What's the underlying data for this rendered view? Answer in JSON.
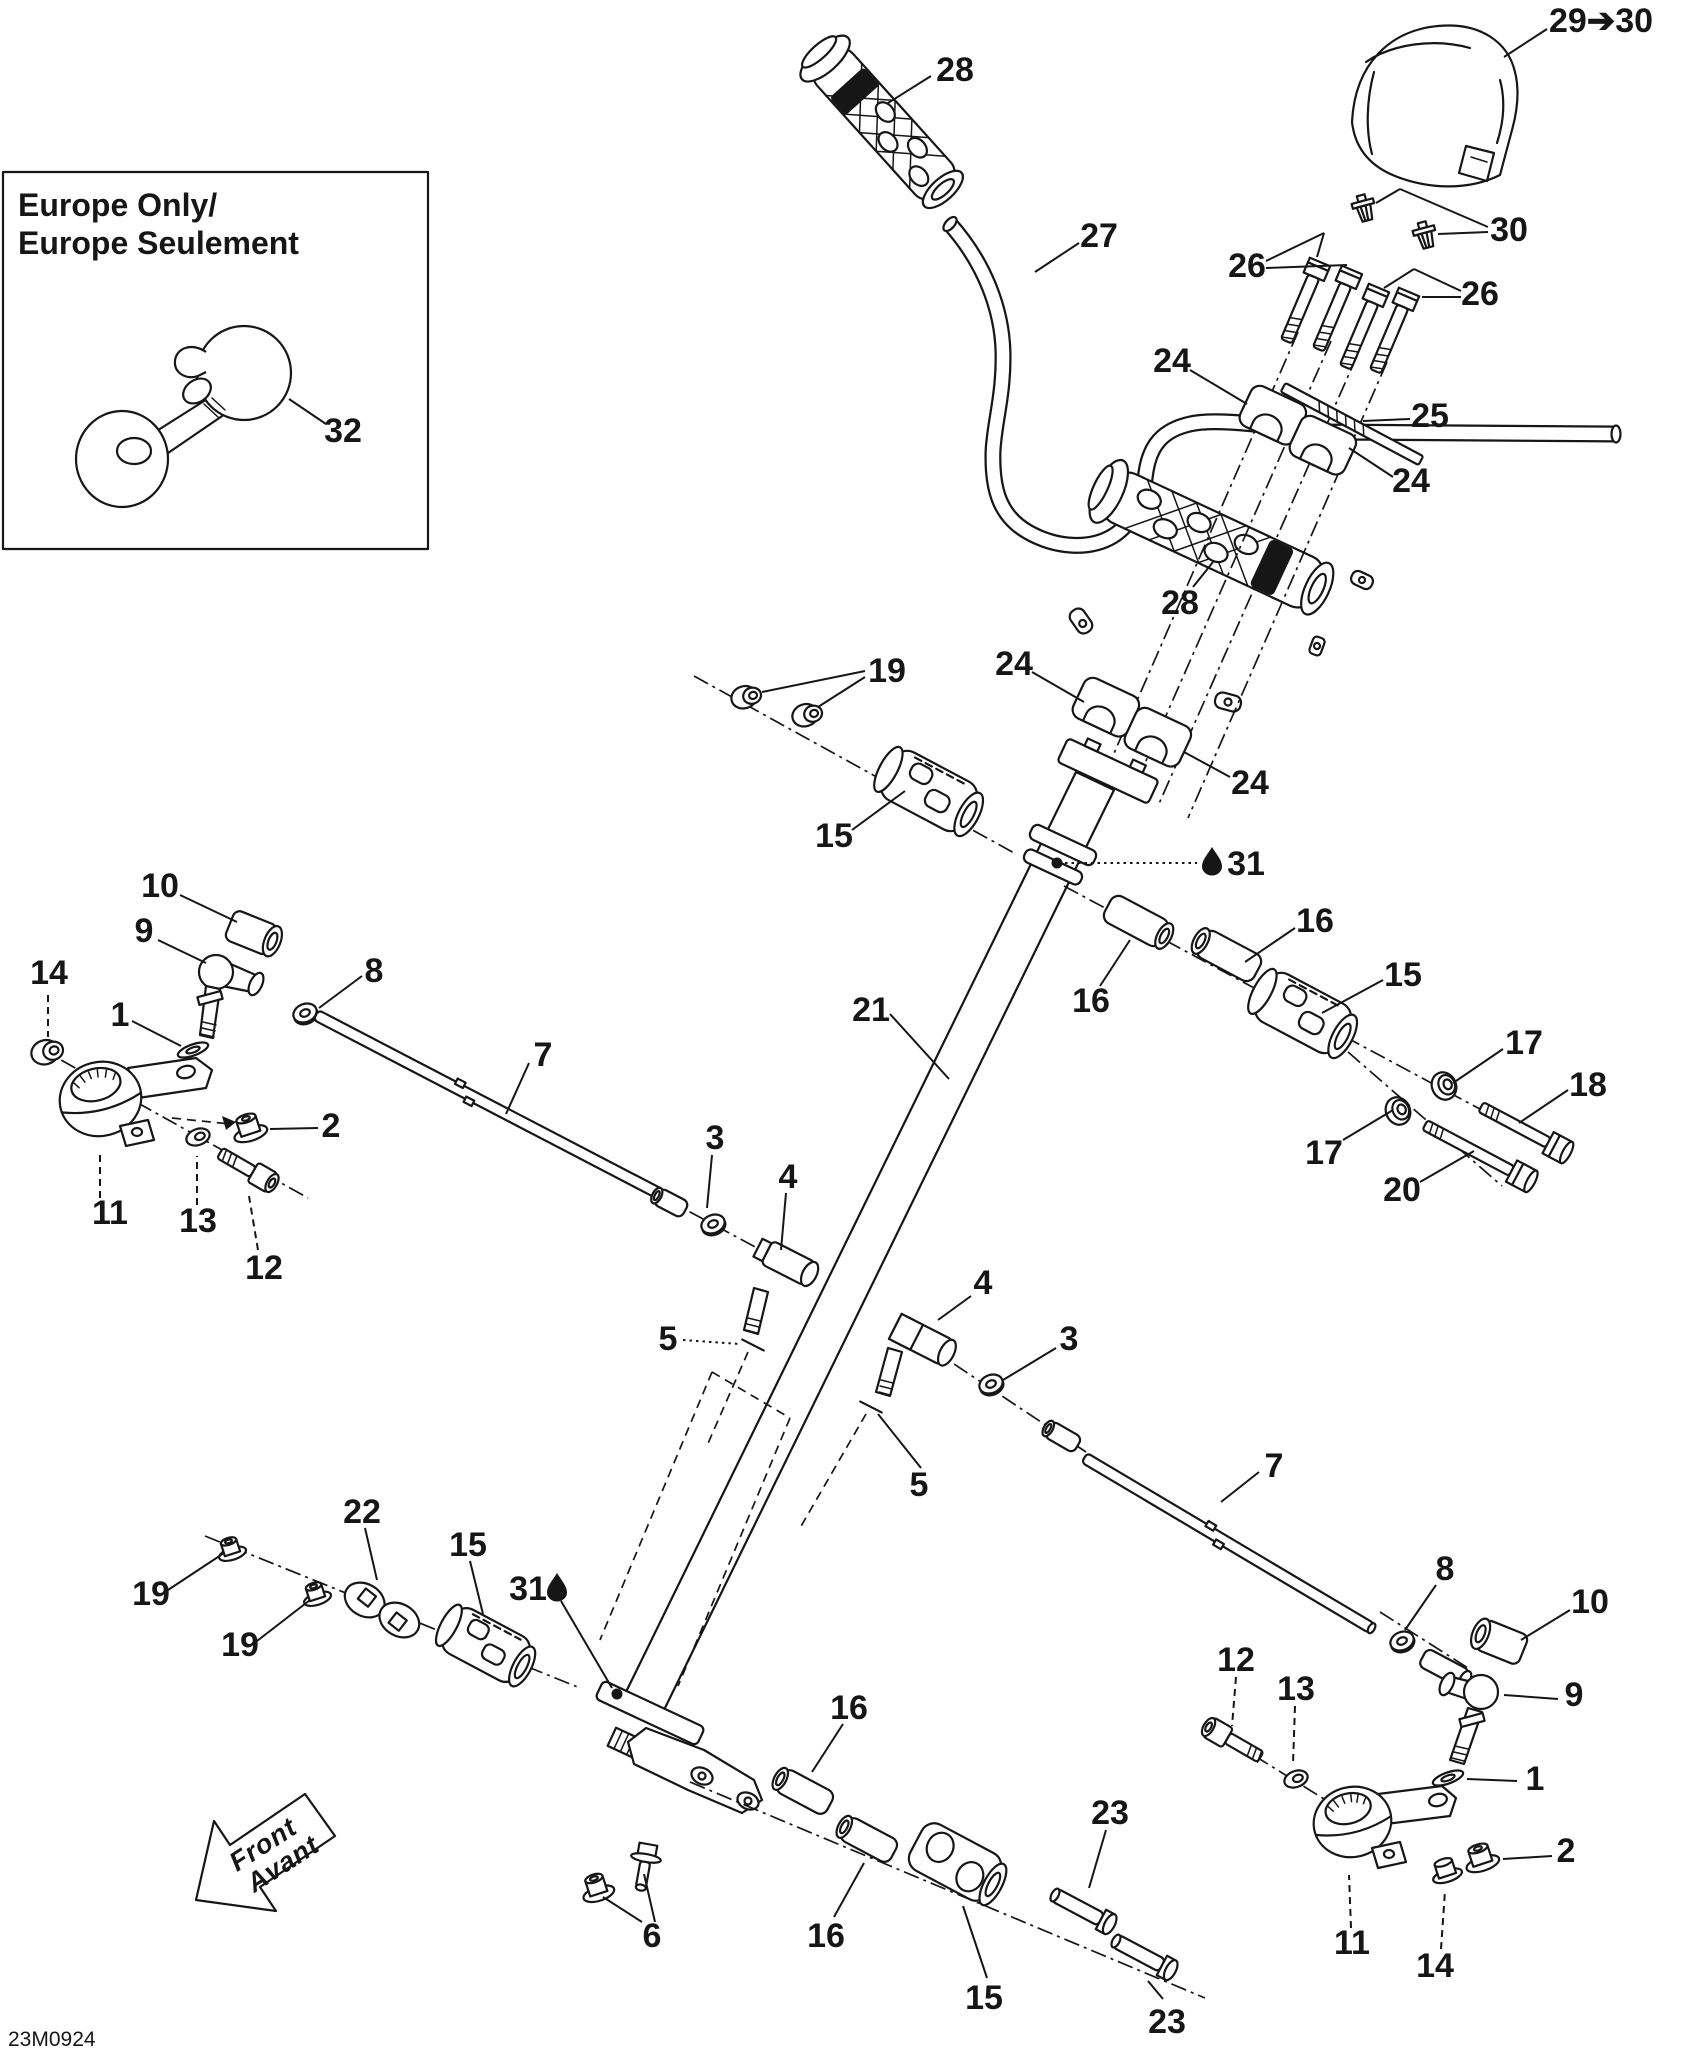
{
  "diagram": {
    "sheet_code": "23M0924",
    "inset": {
      "title": [
        "Europe Only/",
        "Europe Seulement"
      ]
    },
    "front_arrow": [
      "Front",
      "Avant"
    ],
    "colors": {
      "ink": "#161616",
      "paper": "#ffffff"
    },
    "icons": {
      "oil": "oil-drop-icon",
      "horn": "horn-icon",
      "front": "front-direction-arrow-icon"
    },
    "callouts": [
      {
        "t": "32",
        "x": 343,
        "y": 442,
        "leads": [
          [
            289,
            399,
            326,
            424
          ]
        ]
      },
      {
        "t": "28",
        "x": 955,
        "y": 81,
        "leads": [
          [
            888,
            103,
            931,
            76
          ]
        ]
      },
      {
        "t": "29➔30",
        "x": 1601,
        "y": 32,
        "leads": [
          [
            1504,
            57,
            1547,
            29
          ]
        ]
      },
      {
        "t": "30",
        "x": 1509,
        "y": 241,
        "leads": [
          [
            1488,
            227,
            1400,
            189
          ],
          [
            1400,
            189,
            1376,
            203
          ],
          [
            1488,
            232,
            1438,
            234
          ]
        ]
      },
      {
        "t": "26",
        "x": 1247,
        "y": 277,
        "leads": [
          [
            1266,
            261,
            1324,
            233
          ],
          [
            1324,
            233,
            1317,
            257
          ],
          [
            1266,
            268,
            1347,
            265
          ]
        ]
      },
      {
        "t": "26",
        "x": 1480,
        "y": 305,
        "leads": [
          [
            1461,
            291,
            1414,
            269
          ],
          [
            1414,
            269,
            1384,
            288
          ],
          [
            1461,
            297,
            1422,
            297
          ]
        ]
      },
      {
        "t": "24",
        "x": 1172,
        "y": 372,
        "leads": [
          [
            1190,
            370,
            1247,
            404
          ]
        ]
      },
      {
        "t": "25",
        "x": 1430,
        "y": 427,
        "leads": [
          [
            1410,
            419,
            1363,
            421
          ]
        ]
      },
      {
        "t": "24",
        "x": 1411,
        "y": 492,
        "leads": [
          [
            1393,
            477,
            1349,
            448
          ]
        ]
      },
      {
        "t": "27",
        "x": 1099,
        "y": 247,
        "leads": [
          [
            1079,
            243,
            1035,
            272
          ]
        ]
      },
      {
        "t": "28",
        "x": 1180,
        "y": 614,
        "leads": [
          [
            1193,
            587,
            1213,
            562
          ]
        ]
      },
      {
        "t": "24",
        "x": 1014,
        "y": 675,
        "leads": [
          [
            1032,
            672,
            1084,
            702
          ]
        ]
      },
      {
        "t": "24",
        "x": 1250,
        "y": 794,
        "leads": [
          [
            1230,
            777,
            1184,
            752
          ]
        ]
      },
      {
        "t": "19",
        "x": 887,
        "y": 682,
        "leads": [
          [
            865,
            671,
            762,
            692
          ],
          [
            865,
            677,
            818,
            707
          ]
        ]
      },
      {
        "t": "15",
        "x": 834,
        "y": 847,
        "leads": [
          [
            852,
            830,
            905,
            791
          ]
        ]
      },
      {
        "t": "21",
        "x": 871,
        "y": 1021,
        "leads": [
          [
            890,
            1014,
            949,
            1079
          ]
        ]
      },
      {
        "t": "31",
        "x": 1246,
        "y": 875,
        "icon": [
          1212,
          861
        ],
        "dot": [
          1057,
          863
        ],
        "s": "o",
        "leads": [
          [
            1065,
            863,
            1197,
            863
          ]
        ]
      },
      {
        "t": "16",
        "x": 1091,
        "y": 1012,
        "leads": [
          [
            1100,
            986,
            1130,
            940
          ]
        ]
      },
      {
        "t": "16",
        "x": 1315,
        "y": 932,
        "leads": [
          [
            1295,
            928,
            1245,
            962
          ]
        ]
      },
      {
        "t": "15",
        "x": 1403,
        "y": 986,
        "leads": [
          [
            1383,
            980,
            1322,
            1013
          ]
        ]
      },
      {
        "t": "17",
        "x": 1524,
        "y": 1054,
        "leads": [
          [
            1503,
            1049,
            1453,
            1083
          ]
        ]
      },
      {
        "t": "17",
        "x": 1324,
        "y": 1164,
        "leads": [
          [
            1343,
            1140,
            1393,
            1110
          ]
        ]
      },
      {
        "t": "18",
        "x": 1588,
        "y": 1096,
        "leads": [
          [
            1568,
            1090,
            1519,
            1123
          ]
        ]
      },
      {
        "t": "20",
        "x": 1402,
        "y": 1201,
        "leads": [
          [
            1420,
            1182,
            1474,
            1151
          ]
        ]
      },
      {
        "t": "10",
        "x": 160,
        "y": 897,
        "leads": [
          [
            180,
            895,
            237,
            922
          ]
        ]
      },
      {
        "t": "9",
        "x": 144,
        "y": 942,
        "leads": [
          [
            158,
            940,
            206,
            963
          ]
        ]
      },
      {
        "t": "8",
        "x": 374,
        "y": 982,
        "leads": [
          [
            362,
            976,
            319,
            1008
          ]
        ]
      },
      {
        "t": "14",
        "x": 49,
        "y": 984,
        "s": "d",
        "leads": [
          [
            48,
            995,
            48,
            1037
          ]
        ]
      },
      {
        "t": "1",
        "x": 120,
        "y": 1026,
        "leads": [
          [
            132,
            1021,
            181,
            1046
          ]
        ]
      },
      {
        "t": "2",
        "x": 331,
        "y": 1137,
        "leads": [
          [
            318,
            1128,
            270,
            1129
          ]
        ]
      },
      {
        "t": "11",
        "x": 110,
        "y": 1224,
        "s": "d",
        "leads": [
          [
            100,
            1198,
            100,
            1152
          ]
        ]
      },
      {
        "t": "13",
        "x": 198,
        "y": 1232,
        "s": "d",
        "leads": [
          [
            197,
            1205,
            197,
            1156
          ]
        ]
      },
      {
        "t": "12",
        "x": 264,
        "y": 1279,
        "s": "d",
        "leads": [
          [
            258,
            1250,
            249,
            1196
          ]
        ]
      },
      {
        "t": "7",
        "x": 543,
        "y": 1066,
        "leads": [
          [
            529,
            1063,
            506,
            1114
          ]
        ]
      },
      {
        "t": "3",
        "x": 715,
        "y": 1149,
        "leads": [
          [
            712,
            1155,
            707,
            1208
          ]
        ]
      },
      {
        "t": "4",
        "x": 788,
        "y": 1188,
        "leads": [
          [
            786,
            1193,
            781,
            1250
          ]
        ]
      },
      {
        "t": "5",
        "x": 668,
        "y": 1350,
        "s": "o",
        "leads": [
          [
            683,
            1340,
            740,
            1344
          ]
        ]
      },
      {
        "t": "4",
        "x": 983,
        "y": 1294,
        "leads": [
          [
            971,
            1296,
            938,
            1320
          ]
        ]
      },
      {
        "t": "3",
        "x": 1069,
        "y": 1350,
        "leads": [
          [
            1056,
            1348,
            1003,
            1380
          ]
        ]
      },
      {
        "t": "5",
        "x": 919,
        "y": 1496,
        "leads": [
          [
            921,
            1468,
            878,
            1414
          ]
        ]
      },
      {
        "t": "7",
        "x": 1274,
        "y": 1477,
        "leads": [
          [
            1259,
            1472,
            1221,
            1502
          ]
        ]
      },
      {
        "t": "19",
        "x": 151,
        "y": 1605,
        "leads": [
          [
            168,
            1590,
            224,
            1553
          ]
        ]
      },
      {
        "t": "19",
        "x": 240,
        "y": 1656,
        "leads": [
          [
            257,
            1641,
            310,
            1600
          ]
        ]
      },
      {
        "t": "22",
        "x": 362,
        "y": 1523,
        "leads": [
          [
            365,
            1528,
            377,
            1580
          ]
        ]
      },
      {
        "t": "15",
        "x": 468,
        "y": 1556,
        "leads": [
          [
            470,
            1561,
            483,
            1614
          ]
        ]
      },
      {
        "t": "31",
        "x": 528,
        "y": 1600,
        "icon": [
          557,
          1587
        ],
        "dot": [
          617,
          1694
        ],
        "leads": [
          [
            561,
            1601,
            612,
            1688
          ]
        ]
      },
      {
        "t": "16",
        "x": 849,
        "y": 1719,
        "leads": [
          [
            843,
            1724,
            812,
            1772
          ]
        ]
      },
      {
        "t": "16",
        "x": 826,
        "y": 1947,
        "leads": [
          [
            834,
            1917,
            864,
            1863
          ]
        ]
      },
      {
        "t": "15",
        "x": 984,
        "y": 2009,
        "leads": [
          [
            987,
            1978,
            963,
            1906
          ]
        ]
      },
      {
        "t": "23",
        "x": 1110,
        "y": 1824,
        "leads": [
          [
            1106,
            1830,
            1089,
            1888
          ]
        ]
      },
      {
        "t": "23",
        "x": 1167,
        "y": 2033,
        "leads": [
          [
            1163,
            1999,
            1148,
            1981
          ]
        ]
      },
      {
        "t": "6",
        "x": 652,
        "y": 1947,
        "leads": [
          [
            642,
            1922,
            603,
            1897
          ],
          [
            655,
            1922,
            644,
            1874
          ]
        ]
      },
      {
        "t": "8",
        "x": 1445,
        "y": 1580,
        "leads": [
          [
            1436,
            1585,
            1405,
            1630
          ]
        ]
      },
      {
        "t": "10",
        "x": 1590,
        "y": 1613,
        "leads": [
          [
            1570,
            1610,
            1521,
            1640
          ]
        ]
      },
      {
        "t": "9",
        "x": 1574,
        "y": 1706,
        "leads": [
          [
            1558,
            1699,
            1504,
            1695
          ]
        ]
      },
      {
        "t": "12",
        "x": 1236,
        "y": 1671,
        "s": "d",
        "leads": [
          [
            1236,
            1677,
            1232,
            1726
          ]
        ]
      },
      {
        "t": "13",
        "x": 1296,
        "y": 1700,
        "s": "d",
        "leads": [
          [
            1295,
            1706,
            1293,
            1764
          ]
        ]
      },
      {
        "t": "1",
        "x": 1535,
        "y": 1790,
        "leads": [
          [
            1517,
            1781,
            1467,
            1779
          ]
        ]
      },
      {
        "t": "2",
        "x": 1566,
        "y": 1862,
        "leads": [
          [
            1552,
            1856,
            1503,
            1859
          ]
        ]
      },
      {
        "t": "11",
        "x": 1352,
        "y": 1954,
        "s": "d",
        "leads": [
          [
            1351,
            1928,
            1349,
            1875
          ]
        ]
      },
      {
        "t": "14",
        "x": 1435,
        "y": 1977,
        "s": "d",
        "leads": [
          [
            1441,
            1949,
            1445,
            1891
          ]
        ]
      }
    ]
  }
}
